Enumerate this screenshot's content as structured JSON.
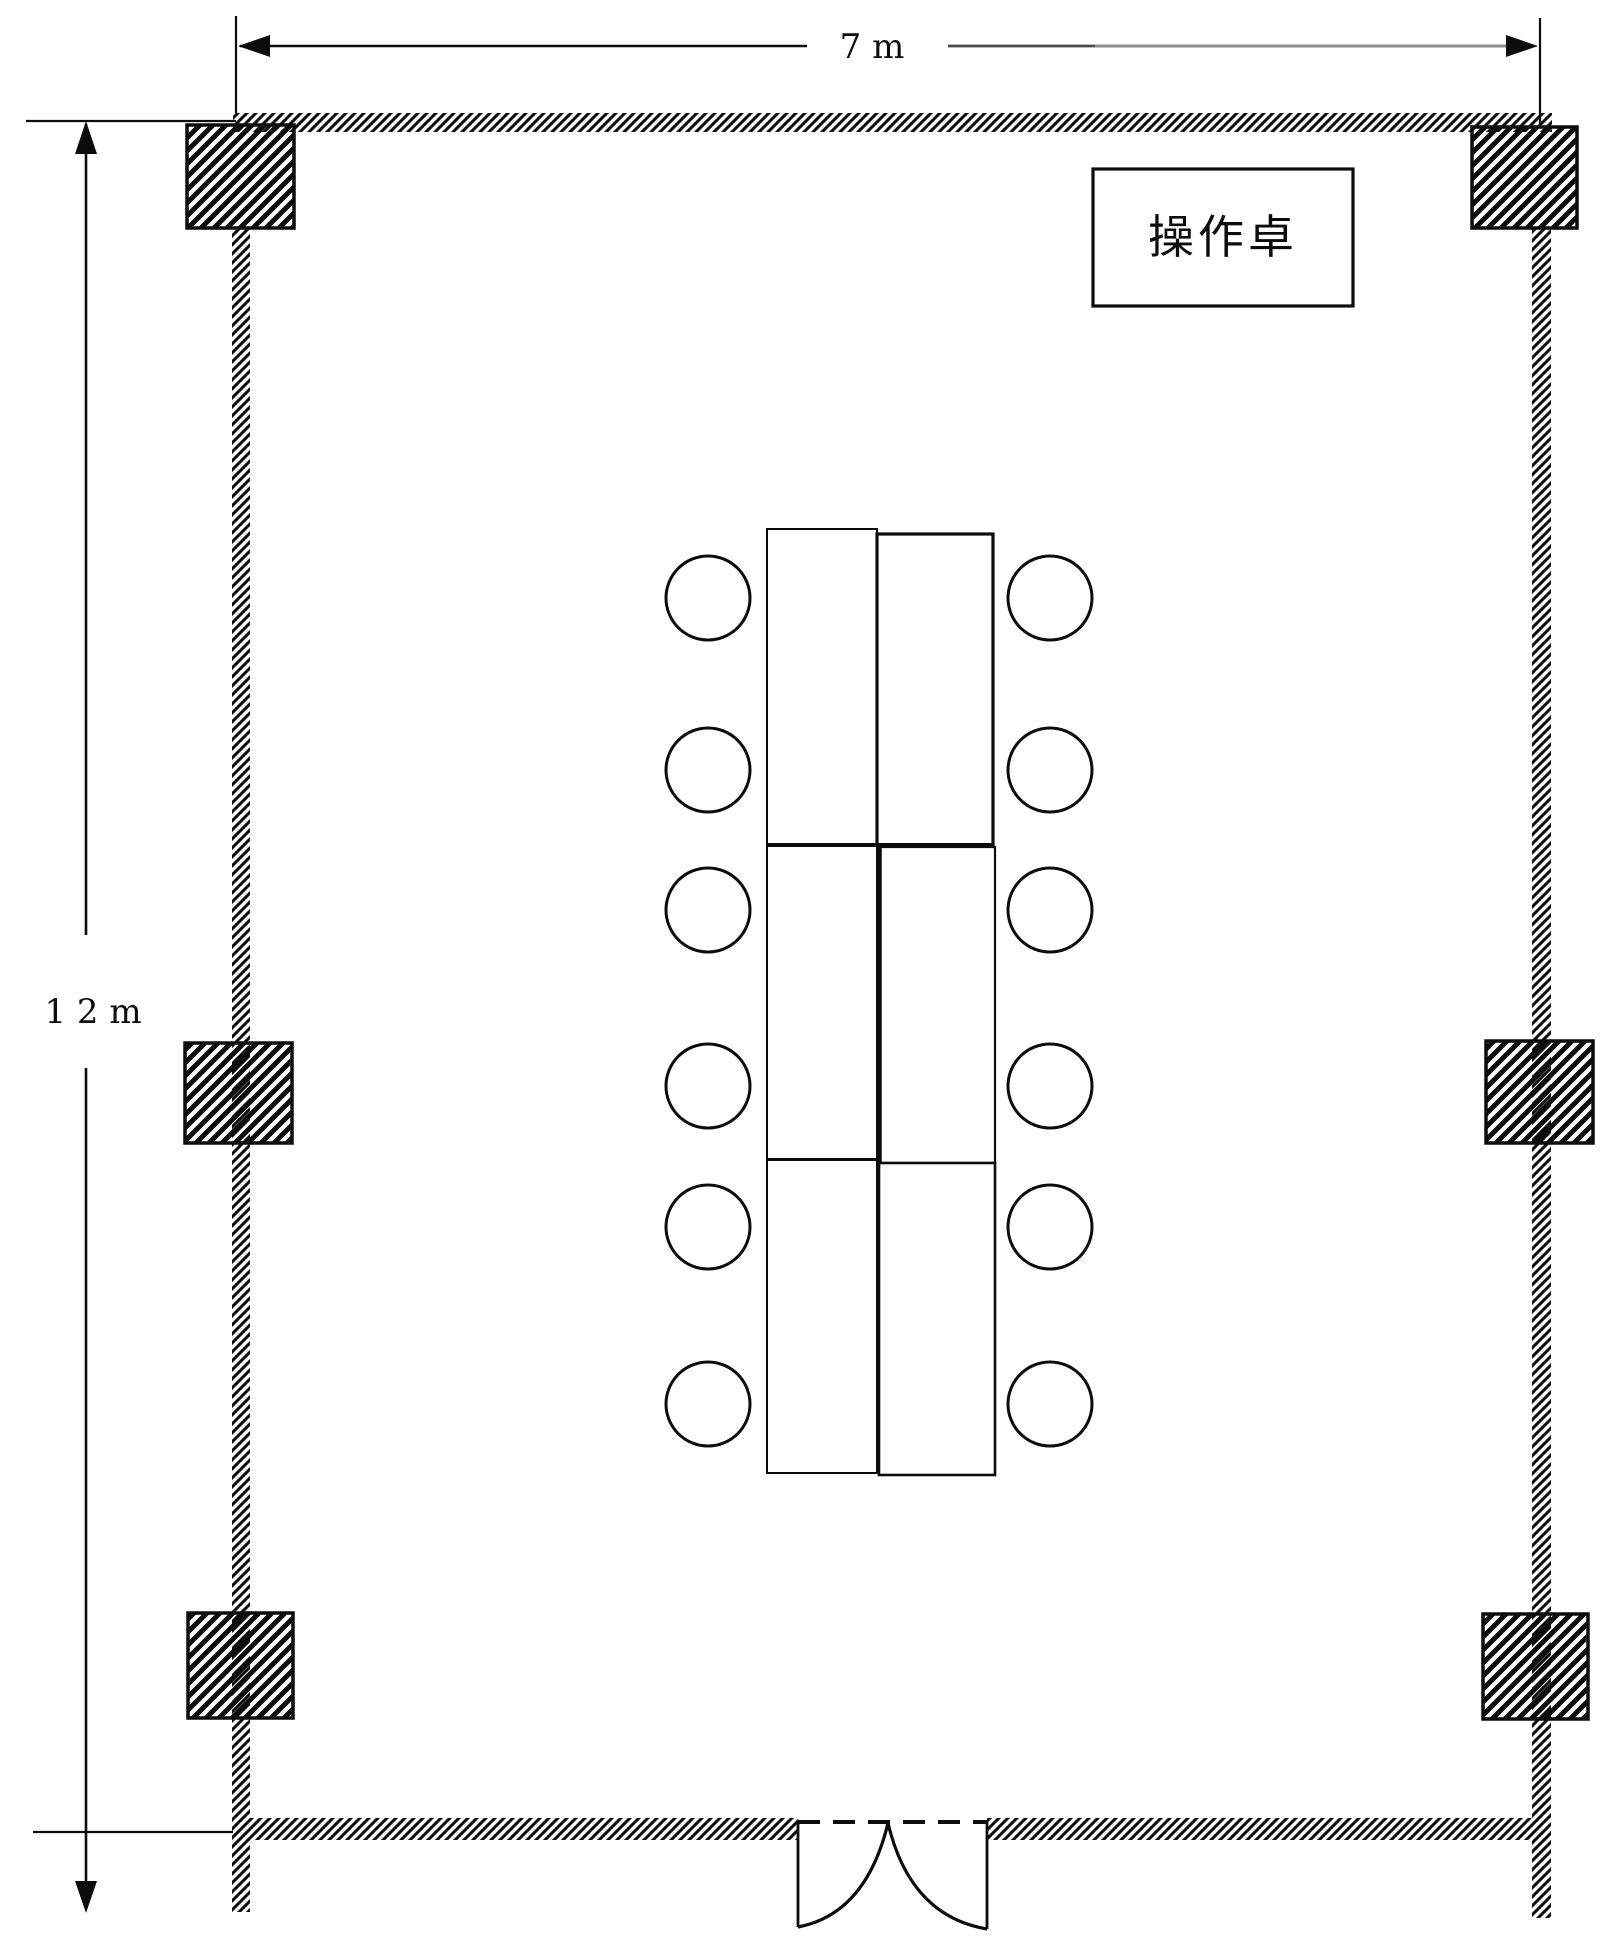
{
  "labels": {
    "width_dimension": "7 m",
    "height_dimension": "1 2 m",
    "console_desk": "操作卓"
  },
  "colors": {
    "background": "#ffffff",
    "line": "#0c0c0c",
    "dim-fade-mid": "#4a4a4a",
    "dim-fade-light": "#8c8c8c"
  },
  "plan": {
    "columns_count": 6,
    "table_sections_count": 6,
    "chairs_count": 12,
    "door_position": "bottom-center",
    "door_type": "double-swing"
  }
}
